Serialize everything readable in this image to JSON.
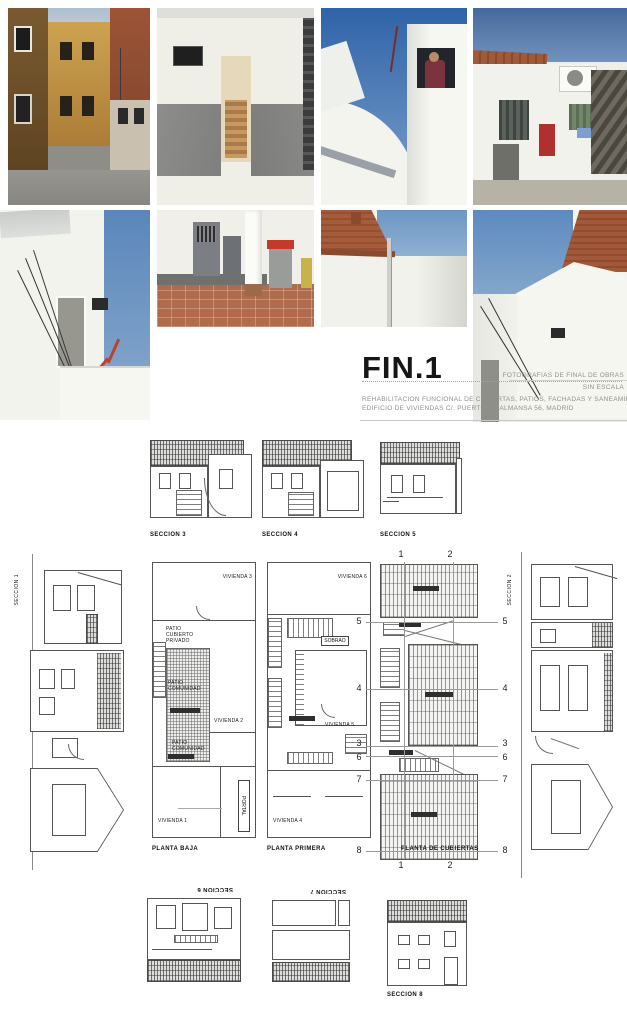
{
  "title_block": {
    "code": "FIN.1",
    "caption_line1": "FOTOGRAFIAS DE FINAL DE OBRAS",
    "caption_line2": "SIN ESCALA",
    "description_line1": "REHABILITACION FUNCIONAL DE CUBIERTAS, PATIOS, FACHADAS Y SANEAMIENTO",
    "description_line2": "EDIFICIO DE VIVIENDAS C/. PUERTO DE ALMANSA 56, MADRID"
  },
  "photos": [
    {
      "name": "street-facades",
      "description": "Narrow street with ochre and brick house facades"
    },
    {
      "name": "interior-corridor",
      "description": "Interior corridor with grey dado and stair at the end"
    },
    {
      "name": "white-tower-person",
      "description": "White rooftop volume with a person at a window against blue sky"
    },
    {
      "name": "courtyard-stairs",
      "description": "Courtyard with white walls, air conditioning unit and external stair"
    },
    {
      "name": "white-wall-cables",
      "description": "White patio wall with door and electrical cables"
    },
    {
      "name": "patio-doors-bin",
      "description": "Covered patio with grey doors, column and wheelie bin"
    },
    {
      "name": "patio-brick-gable",
      "description": "Patio walls with brick gable and downpipe"
    },
    {
      "name": "patio-white-walls",
      "description": "White patio walls with brick gable against blue sky"
    }
  ],
  "sections": {
    "top": [
      "SECCION 3",
      "SECCION 4",
      "SECCION 5"
    ],
    "left": "SECCION 1",
    "right": "SECCION 2",
    "bottom": [
      "SECCION 6",
      "SECCION 7",
      "SECCION 8"
    ]
  },
  "plans": {
    "baja": {
      "caption": "PLANTA BAJA",
      "labels": {
        "viv3": "VIVIENDA 3",
        "patio_cubierto": "PATIO CUBIERTO PRIVADO",
        "patio_comunidad_1": "PATIO COMUNIDAD",
        "viv2": "VIVIENDA 2",
        "patio_comunidad_2": "PATIO COMUNIDAD",
        "viv1": "VIVIENDA 1",
        "portal": "PORTAL"
      }
    },
    "primera": {
      "caption": "PLANTA PRIMERA",
      "labels": {
        "viv6": "VIVIENDA 6",
        "sobrao": "SOBRAO",
        "viv5": "VIVIENDA 5",
        "viv4": "VIVIENDA 4"
      }
    },
    "cubiertas": {
      "caption": "PLANTA DE CUBIERTAS",
      "axis_v": [
        "1",
        "2"
      ],
      "axis_h": [
        "5",
        "4",
        "3",
        "6",
        "7",
        "8"
      ]
    }
  },
  "colors": {
    "sky_blue": "#4f7cb4",
    "ochre_facade": "#c49a4e",
    "brick": "#a0563a",
    "terracotta_floor": "#ad6a4c",
    "wall_white": "#f3f3ee",
    "drawing_line": "#555555",
    "accent_red": "#b53230"
  }
}
